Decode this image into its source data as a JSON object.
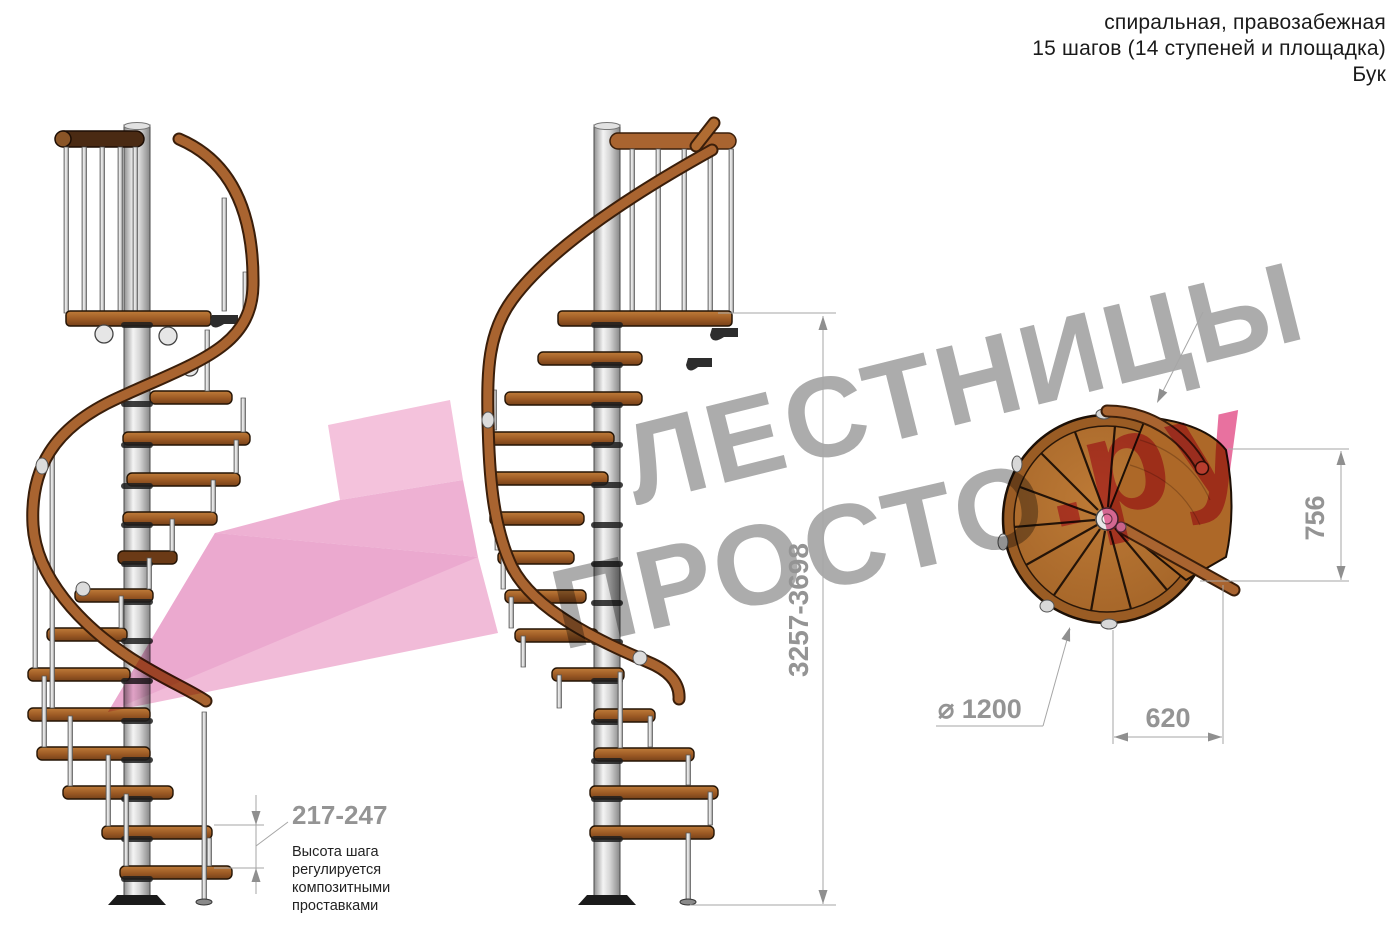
{
  "header": {
    "line1": "спиральная, правозабежная",
    "line2": "15 шагов (14 ступеней и площадка)",
    "line3": "Бук"
  },
  "watermark": {
    "line1": "ЛЕСТНИЦЫ",
    "line2_gray": "ПРОСТО",
    "line2_pink": ".ру",
    "gray_color": "#acacac",
    "pink_color": "#e8719f",
    "arrow_pink_light": "#f4c2dc",
    "arrow_pink_mid": "#eeb1d3",
    "arrow_pink_dark": "#e9a5cb"
  },
  "dimensions": {
    "total_height": "3257-3698",
    "platform_depth": "756",
    "platform_width": "620",
    "diameter": "⌀ 1200",
    "step_height": "217-247"
  },
  "note": {
    "line1": "Высота шага",
    "line2": "регулируется",
    "line3": "композитными",
    "line4": "проставками"
  },
  "colors": {
    "dimension_gray": "#949494",
    "wood_step": "#9c5a24",
    "wood_rail": "#a96430",
    "wood_dark_rail": "#4a2a13",
    "wood_disc": "#b06e2e",
    "pole_silver": "#d9d9d9"
  }
}
